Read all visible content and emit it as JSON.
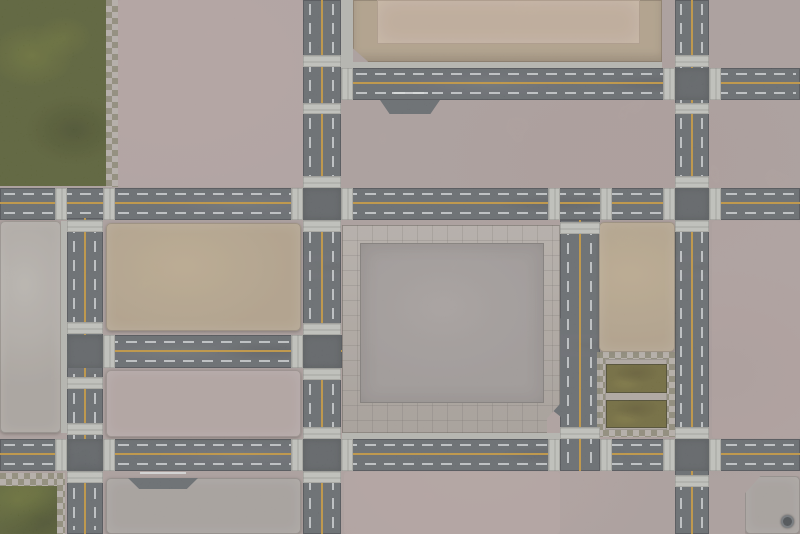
{
  "title": "Urban ruins gaming mat (top-down)",
  "palette": {
    "asphalt": "#5b6065",
    "asphalt_dark": "#53585c",
    "curb": "#b6b8b2",
    "crosswalk": "#c3c5bf",
    "lane_yellow": "#c29231",
    "lane_white": "rgba(222,226,229,0.78)",
    "concrete_base": "#ab9d9b",
    "concrete_pink": "#b2a3a1",
    "concrete_light": "#a9a39d",
    "tan": "#b2a086",
    "tan_light": "#c2ac98",
    "plaza_tile": "#b0a8a1",
    "plaza_inner": "#9d9795",
    "grass_dark": "#4c5423",
    "grass_olive": "#665f2a",
    "checker_light": "#b8b2aa",
    "checker_dark": "#87836f",
    "badge": "#3c4146"
  },
  "regions": {
    "grass_field_top_left": "grass with checkered tile edge",
    "grass_field_bottom_left": "grass with checkered tile edge",
    "grass_enclosure_right": "two olive grass beds in checkered tile frame",
    "central_plaza": "tiled frame with inner concrete square, chamfered SE corner",
    "raised_platform_top": "tan platform with inner step",
    "roads": "asphalt grid with solid yellow center lines, dashed white lanes, crosswalk strips",
    "badge_bottom_right": "small round maker emblem"
  }
}
